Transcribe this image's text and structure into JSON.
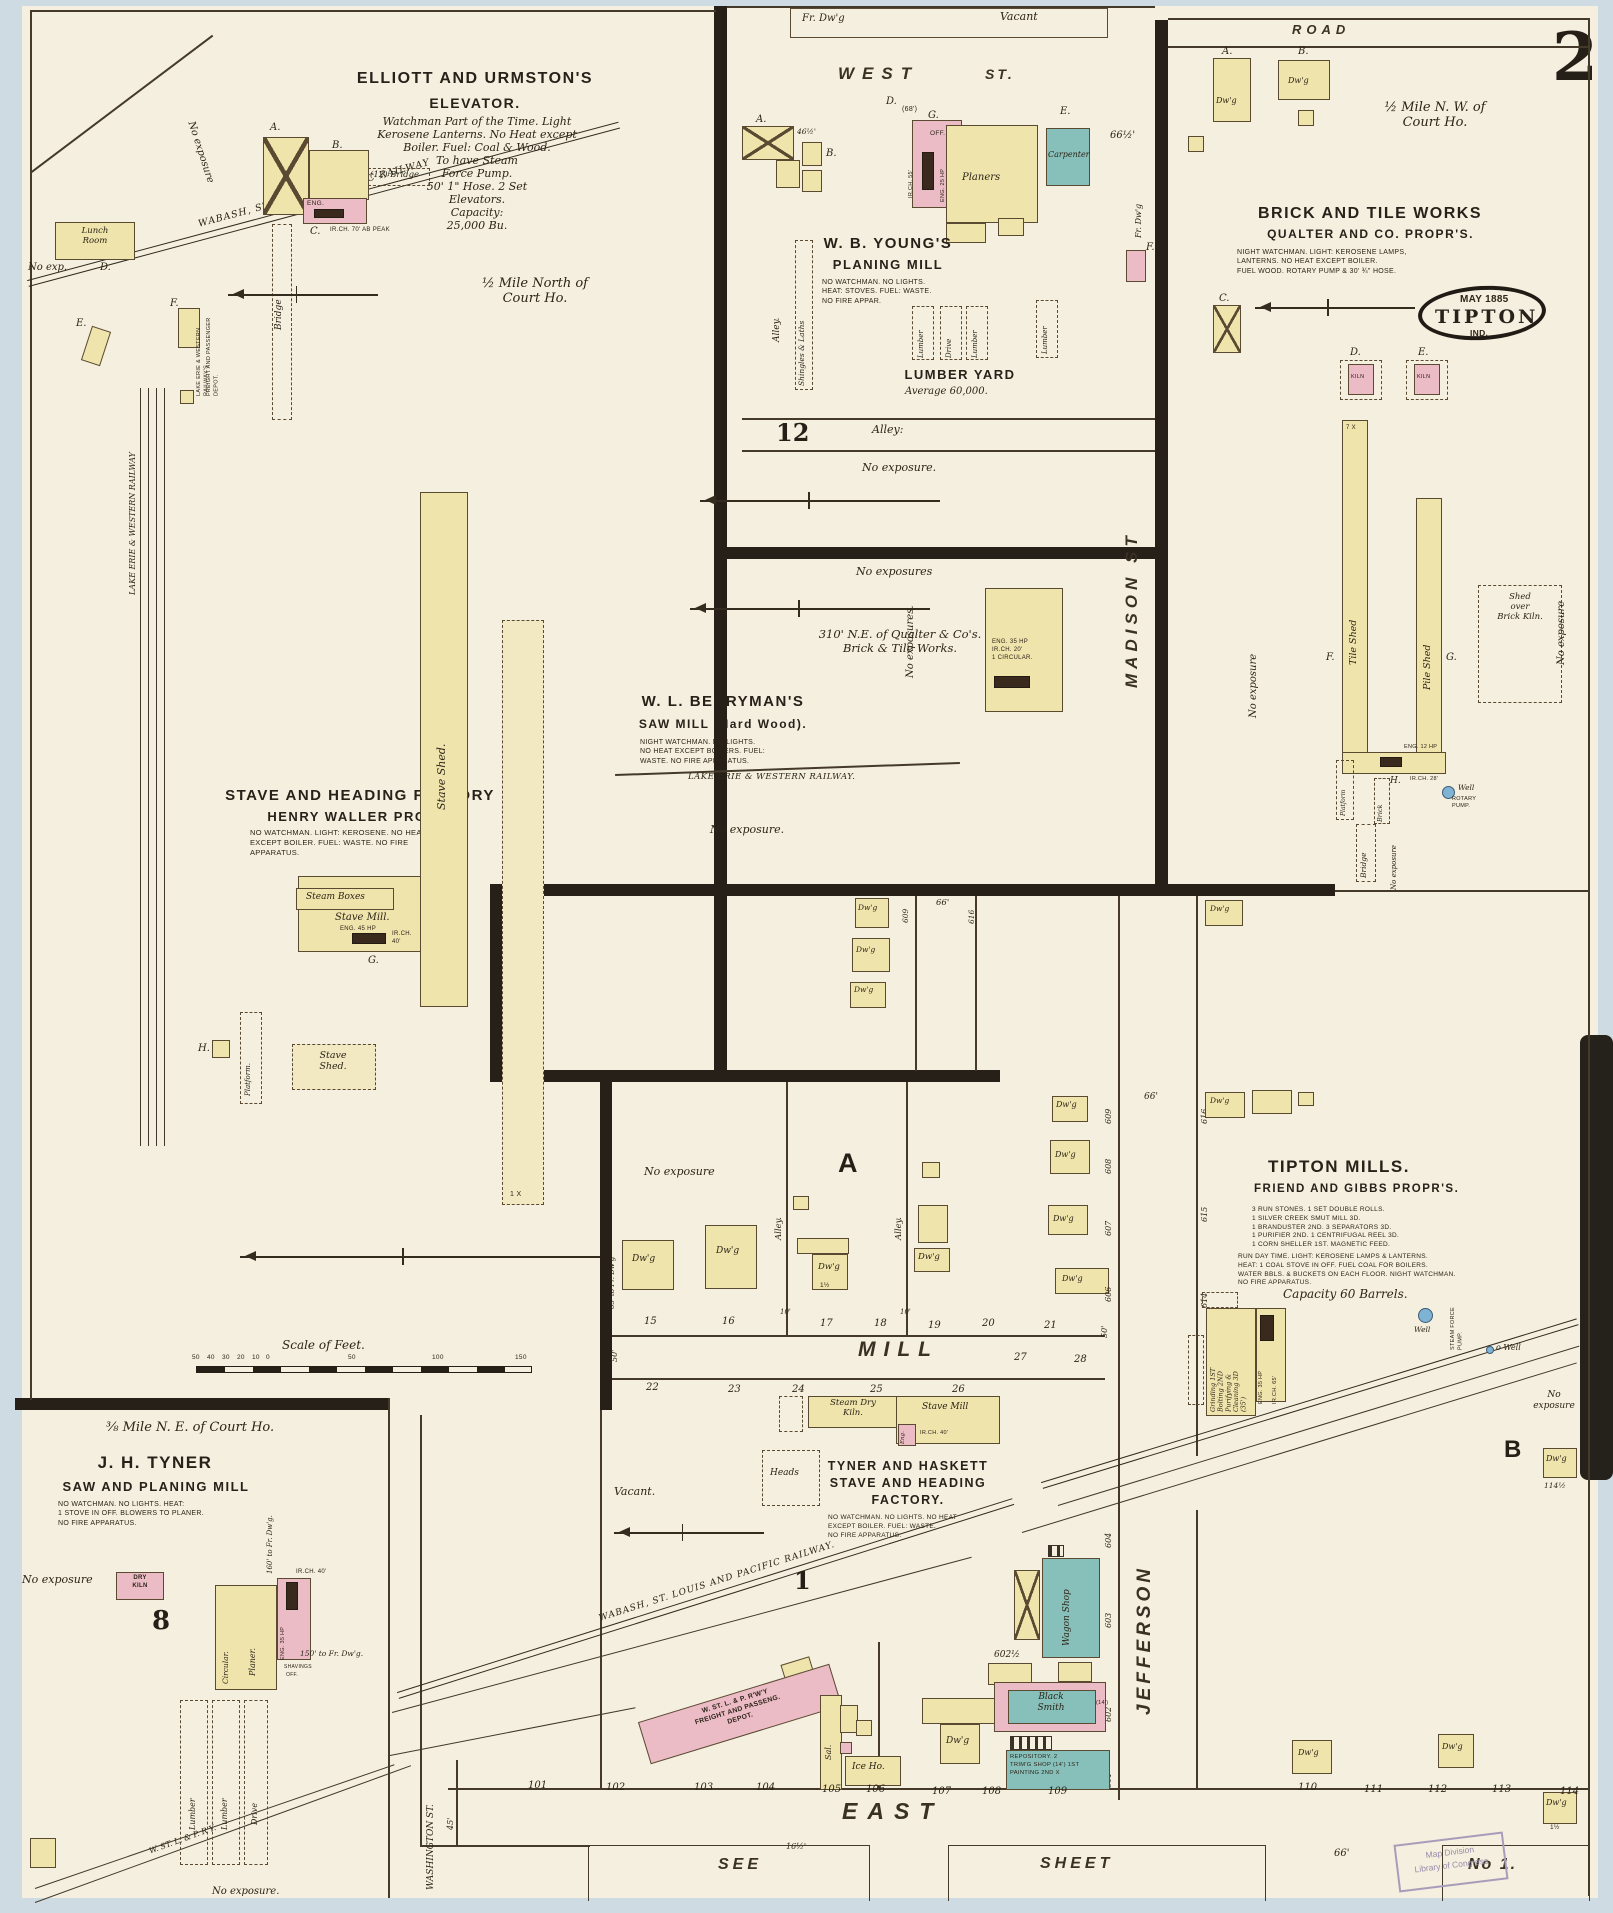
{
  "page": {
    "number": "2",
    "stamp": "Map Division\nLibrary of Congress"
  },
  "streets": {
    "west": "WEST",
    "west_st": "ST.",
    "road": "ROAD",
    "madison": "MADISON ST",
    "mill": "MILL",
    "east": "EAST",
    "jefferson": "JEFFERSON",
    "washington": "WASHINGTON ST.",
    "alley_h": "Alley:",
    "alley_v": "Alley.",
    "see": "SEE",
    "sheet": "SHEET",
    "no1": "No 1."
  },
  "marks": {
    "dwg": "Dw'g",
    "x7": "7 X",
    "x1": "1 X",
    "x": "X",
    "h1": "1½"
  },
  "scale": {
    "label": "Scale of Feet.",
    "ticks": [
      "50",
      "40",
      "30",
      "20",
      "10",
      "0",
      "50",
      "100",
      "150"
    ]
  },
  "elev": {
    "t1": "ELLIOTT AND URMSTON'S",
    "t2": "ELEVATOR.",
    "notes": "Watchman Part of the Time. Light\nKerosene Lanterns. No Heat except\nBoiler. Fuel: Coal & Wood.\nTo have Steam\nForce Pump.\n50' 1\" Hose. 2 Set\nElevators.\nCapacity:\n25,000 Bu.",
    "half": "½ Mile North of\nCourt Ho.",
    "la": "A.",
    "lb": "B.",
    "lc": "C.",
    "ld": "D.",
    "le": "E.",
    "lf": "F.",
    "bridge_h": "(12) Bridge",
    "bridge_v": "Bridge",
    "eng": "ENG.",
    "irch": "IR.CH. 70' AB PEAK",
    "lunch": "Lunch\nRoom",
    "noexp": "No exp.",
    "noexp2": "No exposure",
    "lew1": "LAKE ERIE & WESTERN RAILWAY'S",
    "lew2": "FREIGHT AND PASSENGER DEPOT.",
    "rail": "WABASH, ST. LOUIS & PACIFIC RAILWAY",
    "rail_lew": "LAKE ERIE & WESTERN RAILWAY"
  },
  "waller": {
    "t1": "STAVE AND HEADING FACTORY",
    "t2": "HENRY WALLER PROPR.",
    "notes": "NO WATCHMAN. LIGHT: KEROSENE. NO HEAT\nEXCEPT BOILER. FUEL: WASTE. NO FIRE\nAPPARATUS.",
    "steam": "Steam Boxes",
    "mill": "Stave Mill.",
    "eng": "ENG. 45 HP",
    "irch": "IR.CH. 40'",
    "g": "G.",
    "h": "H.",
    "platform": "Platform.",
    "shed": "Stave\nShed.",
    "strip": "Stave Shed."
  },
  "young": {
    "frdwg": "Fr. Dw'g",
    "vacant": "Vacant",
    "t1": "W. B. YOUNG'S",
    "t2": "PLANING MILL",
    "notes": "NO WATCHMAN. NO LIGHTS.\nHEAT: STOVES. FUEL: WASTE.\nNO FIRE APPAR.",
    "la": "A.",
    "lb": "B.",
    "lg": "G.",
    "ld": "D.",
    "le": "E.",
    "lf": "F.",
    "w46": "46½'",
    "w68": "(68')",
    "w66": "66½'",
    "carp": "Carpenter",
    "planers": "Planers",
    "off": "OFF.",
    "eng": "ENG. 25 HP",
    "irch": "IR.CH. 55'",
    "shingles": "Shingles & Laths",
    "lumber": "Lumber",
    "drive": "Drive",
    "yard": "LUMBER YARD",
    "avg": "Average 60,000.",
    "n12": "12",
    "noexp": "No exposure.",
    "frdwg_v": "Fr. Dw'g"
  },
  "berry": {
    "noexps": "No exposures",
    "dist": "310' N.E. of Qualter & Co's.\nBrick & Tile Works.",
    "t1": "W. L. BERRYMAN'S",
    "t2": "SAW MILL (Hard Wood).",
    "notes": "NIGHT WATCHMAN. NO LIGHTS.\nNO HEAT EXCEPT BOILERS. FUEL:\nWASTE. NO FIRE APPARATUS.",
    "mach": "ENG. 35 HP\nIR.CH. 20'\n1 CIRCULAR.",
    "noexps_v": "No exposures.",
    "rail": "LAKE ERIE & WESTERN RAILWAY.",
    "noexp": "No exposure."
  },
  "brick": {
    "half": "½ Mile N. W. of\nCourt Ho.",
    "t1": "BRICK AND TILE WORKS",
    "t2": "QUALTER AND CO. PROPR'S.",
    "notes": "NIGHT WATCHMAN. LIGHT: KEROSENE LAMPS,\nLANTERNS. NO HEAT EXCEPT BOILER.\nFUEL WOOD. ROTARY PUMP & 30' ¾\" HOSE.",
    "may": "MAY 1885",
    "city": "TIPTON",
    "ind": "IND.",
    "la": "A.",
    "lb": "B.",
    "lc": "C.",
    "ld": "D.",
    "le": "E.",
    "lf": "F.",
    "lg": "G.",
    "lh": "H.",
    "kiln": "KILN",
    "tile": "Tile Shed",
    "pile": "Pile Shed",
    "shed_over": "Shed\nover\nBrick Kiln.",
    "eng": "ENG. 12 HP",
    "irch": "IR.CH. 28'",
    "well": "Well",
    "rotary": "ROTARY\nPUMP.",
    "bridge": "Bridge",
    "brickv": "Brick",
    "platform": "Platform",
    "noexp": "No exposure"
  },
  "blocka": {
    "a": "A",
    "noexp": "No exposure",
    "tofr": "65' to Fr. Dw'g",
    "n66": "66'",
    "lots": [
      "15",
      "16",
      "17",
      "18",
      "19",
      "20",
      "21"
    ],
    "ten": "10'",
    "w50": "50'",
    "n609": "609",
    "n616": "616"
  },
  "jeff": {
    "w": [
      "609",
      "608",
      "607",
      "606"
    ],
    "e": [
      "616",
      "615",
      "614"
    ],
    "s": [
      "604",
      "603",
      "602",
      "601"
    ],
    "n66": "66'",
    "n602h": "602½"
  },
  "mills": {
    "t1": "TIPTON MILLS.",
    "t2": "FRIEND AND GIBBS PROPR'S.",
    "mach": "3 RUN STONES. 1 SET DOUBLE ROLLS.\n1 SILVER CREEK SMUT MILL 3D.\n1 BRANDUSTER 2ND. 3 SEPARATORS 3D.\n1 PURIFIER 2ND. 1 CENTRIFUGAL REEL 3D.\n1 CORN SHELLER 1ST. MAGNETIC FEED.",
    "ops": "RUN DAY TIME. LIGHT: KEROSENE LAMPS & LANTERNS.\nHEAT: 1 COAL STOVE IN OFF. FUEL COAL FOR BOILERS.\nWATER BBLS. & BUCKETS ON EACH FLOOR. NIGHT WATCHMAN.\nNO FIRE APPARATUS.",
    "cap": "Capacity 60 Barrels.",
    "floors": "Grinding 1ST\nBolting 2ND\nPurifying &\nCleaning 3D\n(35')",
    "eng": "ENG. 35 HP",
    "irch": "IR.CH. 65'",
    "well": "Well",
    "pump": "STEAM FORCE\nPUMP.",
    "owell": "o Well",
    "noexp": "No\nexposure",
    "b": "B",
    "n114": "114½",
    "lots": [
      "110",
      "111",
      "112",
      "113",
      "114"
    ]
  },
  "tyner": {
    "dist": "⅜ Mile N. E. of Court Ho.",
    "t1": "J. H. TYNER",
    "t2": "SAW AND PLANING MILL",
    "notes": "NO WATCHMAN. NO LIGHTS. HEAT:\n1 STOVE IN OFF. BLOWERS TO PLANER.\nNO FIRE APPARATUS.",
    "noexp": "No exposure",
    "dry": "DRY\nKILN",
    "n8": "8",
    "circ": "Circular.",
    "planer": "Planer.",
    "eng": "ENG. 35 HP",
    "irch": "IR.CH. 40'",
    "shav": "SHAVINGS",
    "off": "OFF.",
    "to160": "160' to Fr. Dw'g.",
    "to150": "150' to Fr. Dw'g.",
    "lumber": "Lumber",
    "drive": "Drive",
    "rail": "W. ST. L. & P. R'Y.",
    "noexp2": "No exposure."
  },
  "th": {
    "kiln": "Steam Dry\nKiln.",
    "mill": "Stave Mill",
    "eng": "Eng.",
    "irch": "IR.CH. 40'",
    "heads": "Heads",
    "t": "TYNER AND HASKETT\nSTAVE AND HEADING\nFACTORY.",
    "notes": "NO WATCHMAN. NO LIGHTS. NO HEAT\nEXCEPT BOILER. FUEL: WASTE.\nNO FIRE APPARATUS.",
    "vacant": "Vacant.",
    "n1": "1",
    "rail": "WABASH, ST. LOUIS AND PACIFIC RAILWAY.",
    "lots": [
      "22",
      "23",
      "24",
      "25",
      "26",
      "27",
      "28"
    ]
  },
  "depot": {
    "d": "W. ST. L. & P. R'W'Y\nFREIGHT AND PASSENG.\nDEPOT.",
    "sal": "Sal.",
    "ice": "Ice Ho.",
    "wagon": "Wagon Shop",
    "smith": "Black\nSmith",
    "n14": "(14')",
    "repo": "REPOSITORY. 2\nTRIM'G SHOP (14') 1ST\nPAINTING 2ND X",
    "lots": [
      "101",
      "102",
      "103",
      "104",
      "105",
      "106",
      "107",
      "108",
      "109"
    ],
    "w45": "45'",
    "w16": "16½'",
    "n66": "66'"
  }
}
